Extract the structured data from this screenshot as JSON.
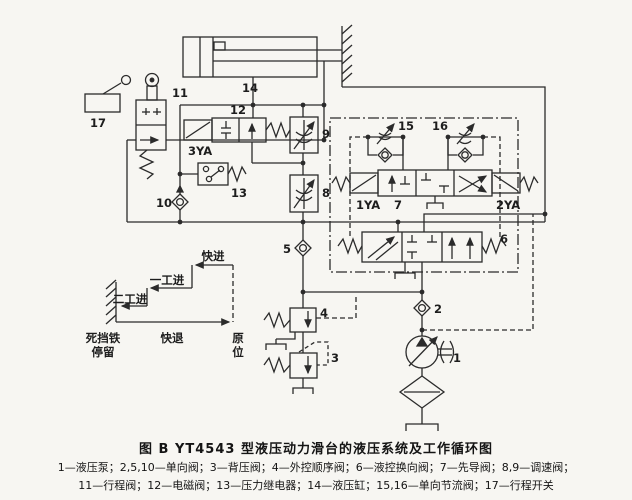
{
  "figure": {
    "caption": "图  B   YT4543 型液压动力滑台的液压系统及工作循环图",
    "legend_line1": "1—液压泵；2,5,10—单向阀；3—背压阀；4—外控顺序阀；6—液控换向阀；7—先导阀；8,9—调速阀；",
    "legend_line2": "11—行程阀；12—电磁阀；13—压力继电器；14—液压缸；15,16—单向节流阀；17—行程开关"
  },
  "components": {
    "n1": "1",
    "n2": "2",
    "n3": "3",
    "n4": "4",
    "n5": "5",
    "n6": "6",
    "n7": "7",
    "n8": "8",
    "n9": "9",
    "n10": "10",
    "n11": "11",
    "n12": "12",
    "n13": "13",
    "n14": "14",
    "n15": "15",
    "n16": "16",
    "n17": "17",
    "ya1": "1YA",
    "ya2": "2YA",
    "ya3": "3YA"
  },
  "cycle": {
    "rapid_advance": "快进",
    "first_feed": "一工进",
    "second_feed": "二工进",
    "dead_stop_line1": "死挡铁",
    "dead_stop_line2": "停留",
    "rapid_return": "快退",
    "home_line1": "原",
    "home_line2": "位"
  },
  "colors": {
    "line": "#2b2b2b",
    "background": "#f7f6f2"
  }
}
